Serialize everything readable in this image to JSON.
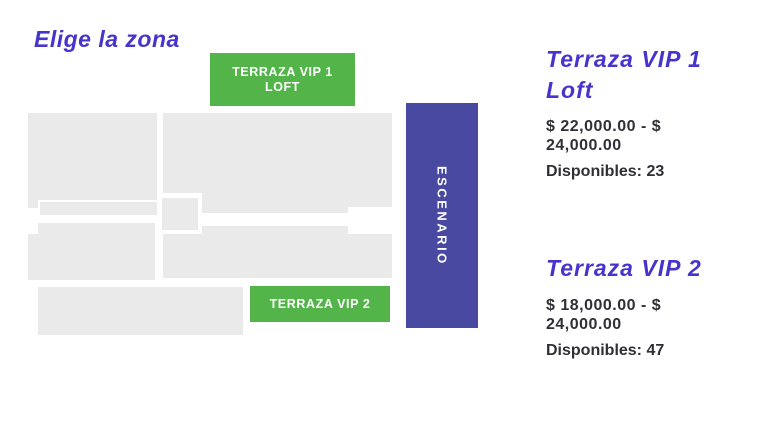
{
  "colors": {
    "accent_purple": "#4634cd",
    "zone_green": "#53b449",
    "stage_purple": "#4a49a1",
    "block_gray": "#eaeaea",
    "text_dark": "#2f2f36"
  },
  "header": {
    "title": "Elige la zona"
  },
  "map": {
    "stage_label": "ESCENARIO",
    "buttons": [
      {
        "id": "terraza-vip-1-loft",
        "label": "TERRAZA VIP 1 LOFT"
      },
      {
        "id": "terraza-vip-2",
        "label": "TERRAZA VIP 2"
      }
    ]
  },
  "zones": [
    {
      "name": "Terraza VIP 1 Loft",
      "price_range": "$ 22,000.00 - $ 24,000.00",
      "available_label": "Disponibles:",
      "available_count": "23"
    },
    {
      "name": "Terraza VIP 2",
      "price_range": "$ 18,000.00 - $ 24,000.00",
      "available_label": "Disponibles:",
      "available_count": "47"
    }
  ]
}
